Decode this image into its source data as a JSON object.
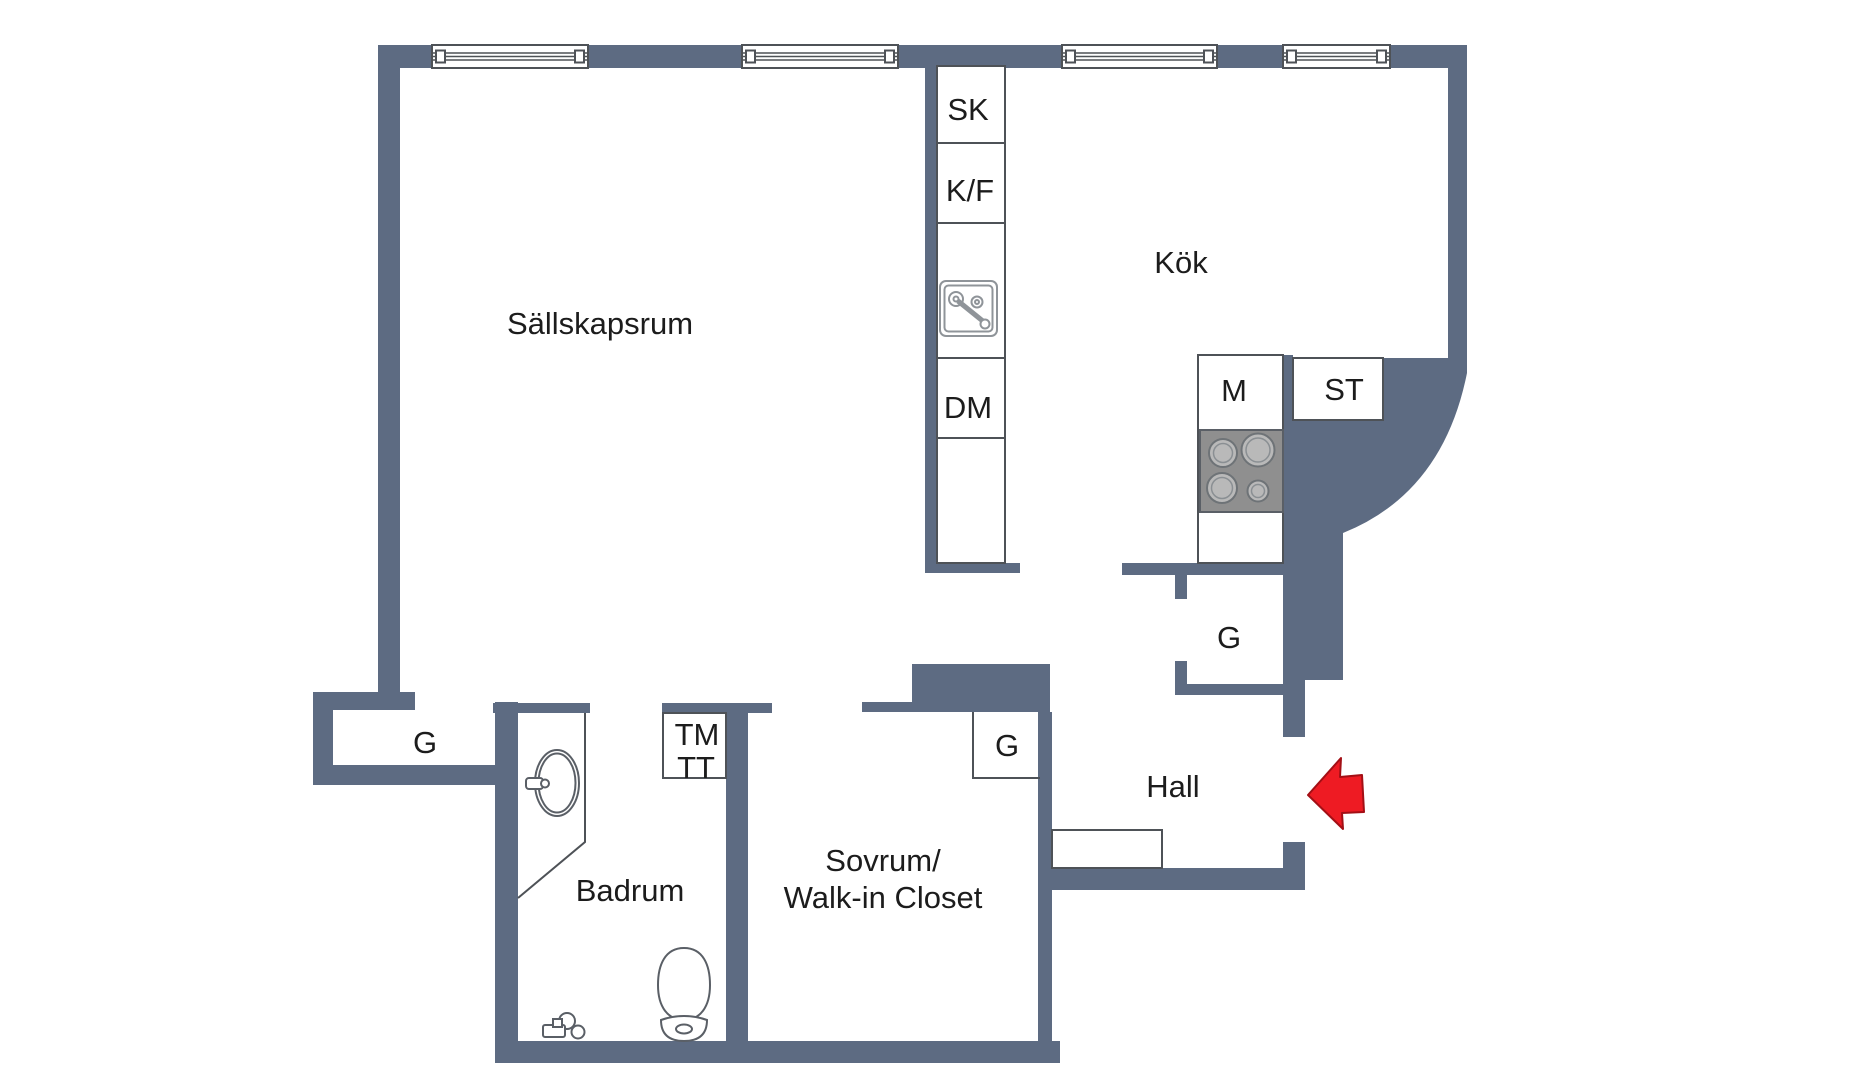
{
  "colors": {
    "wall": "#5d6b82",
    "line": "#4e5257",
    "text": "#1c1c1c",
    "arrow": "#ee1b23",
    "appliance": "#8f8f8f",
    "appliance_detail": "#b9b9b9",
    "background": "#ffffff"
  },
  "rooms": {
    "livingroom": "Sällskapsrum",
    "kitchen": "Kök",
    "hall": "Hall",
    "bathroom": "Badrum",
    "bedroom_line1": "Sovrum/",
    "bedroom_line2": "Walk-in Closet"
  },
  "cabinets": {
    "sk": "SK",
    "kf": "K/F",
    "dm": "DM",
    "m": "M",
    "st": "ST",
    "tm": "TM",
    "tt": "TT"
  },
  "wardrobes": {
    "kitchen": "G",
    "bedroom": "G",
    "entry": "G"
  }
}
